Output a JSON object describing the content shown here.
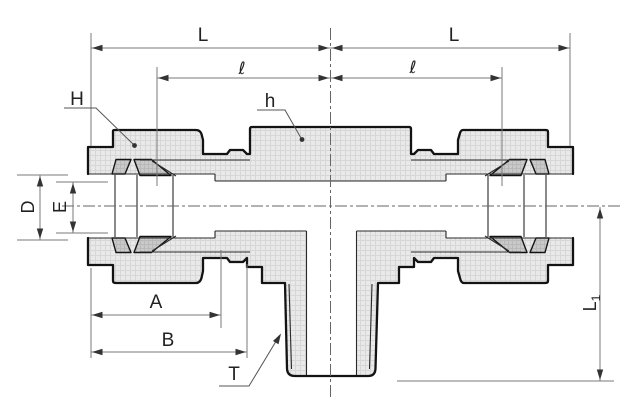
{
  "drawing": {
    "description": "Sectioned technical drawing of a male branch tee compression tube fitting with two nuts, ferrules and a tapered male thread branch",
    "labels": {
      "L_left": "L",
      "L_right": "L",
      "l_left": "ℓ",
      "l_right": "ℓ",
      "H": "H",
      "h": "h",
      "D": "D",
      "E": "E",
      "A": "A",
      "B": "B",
      "T": "T",
      "L1_base": "L",
      "L1_sub": "1"
    },
    "colors": {
      "background": "#ffffff",
      "outline": "#131313",
      "body_fill": "#e9e9e9",
      "hatch_line": "#d7d7d7",
      "ferrule_fill": "#c9c9c9",
      "dimension_line": "#7a7a7a",
      "label_text": "#222222"
    }
  }
}
